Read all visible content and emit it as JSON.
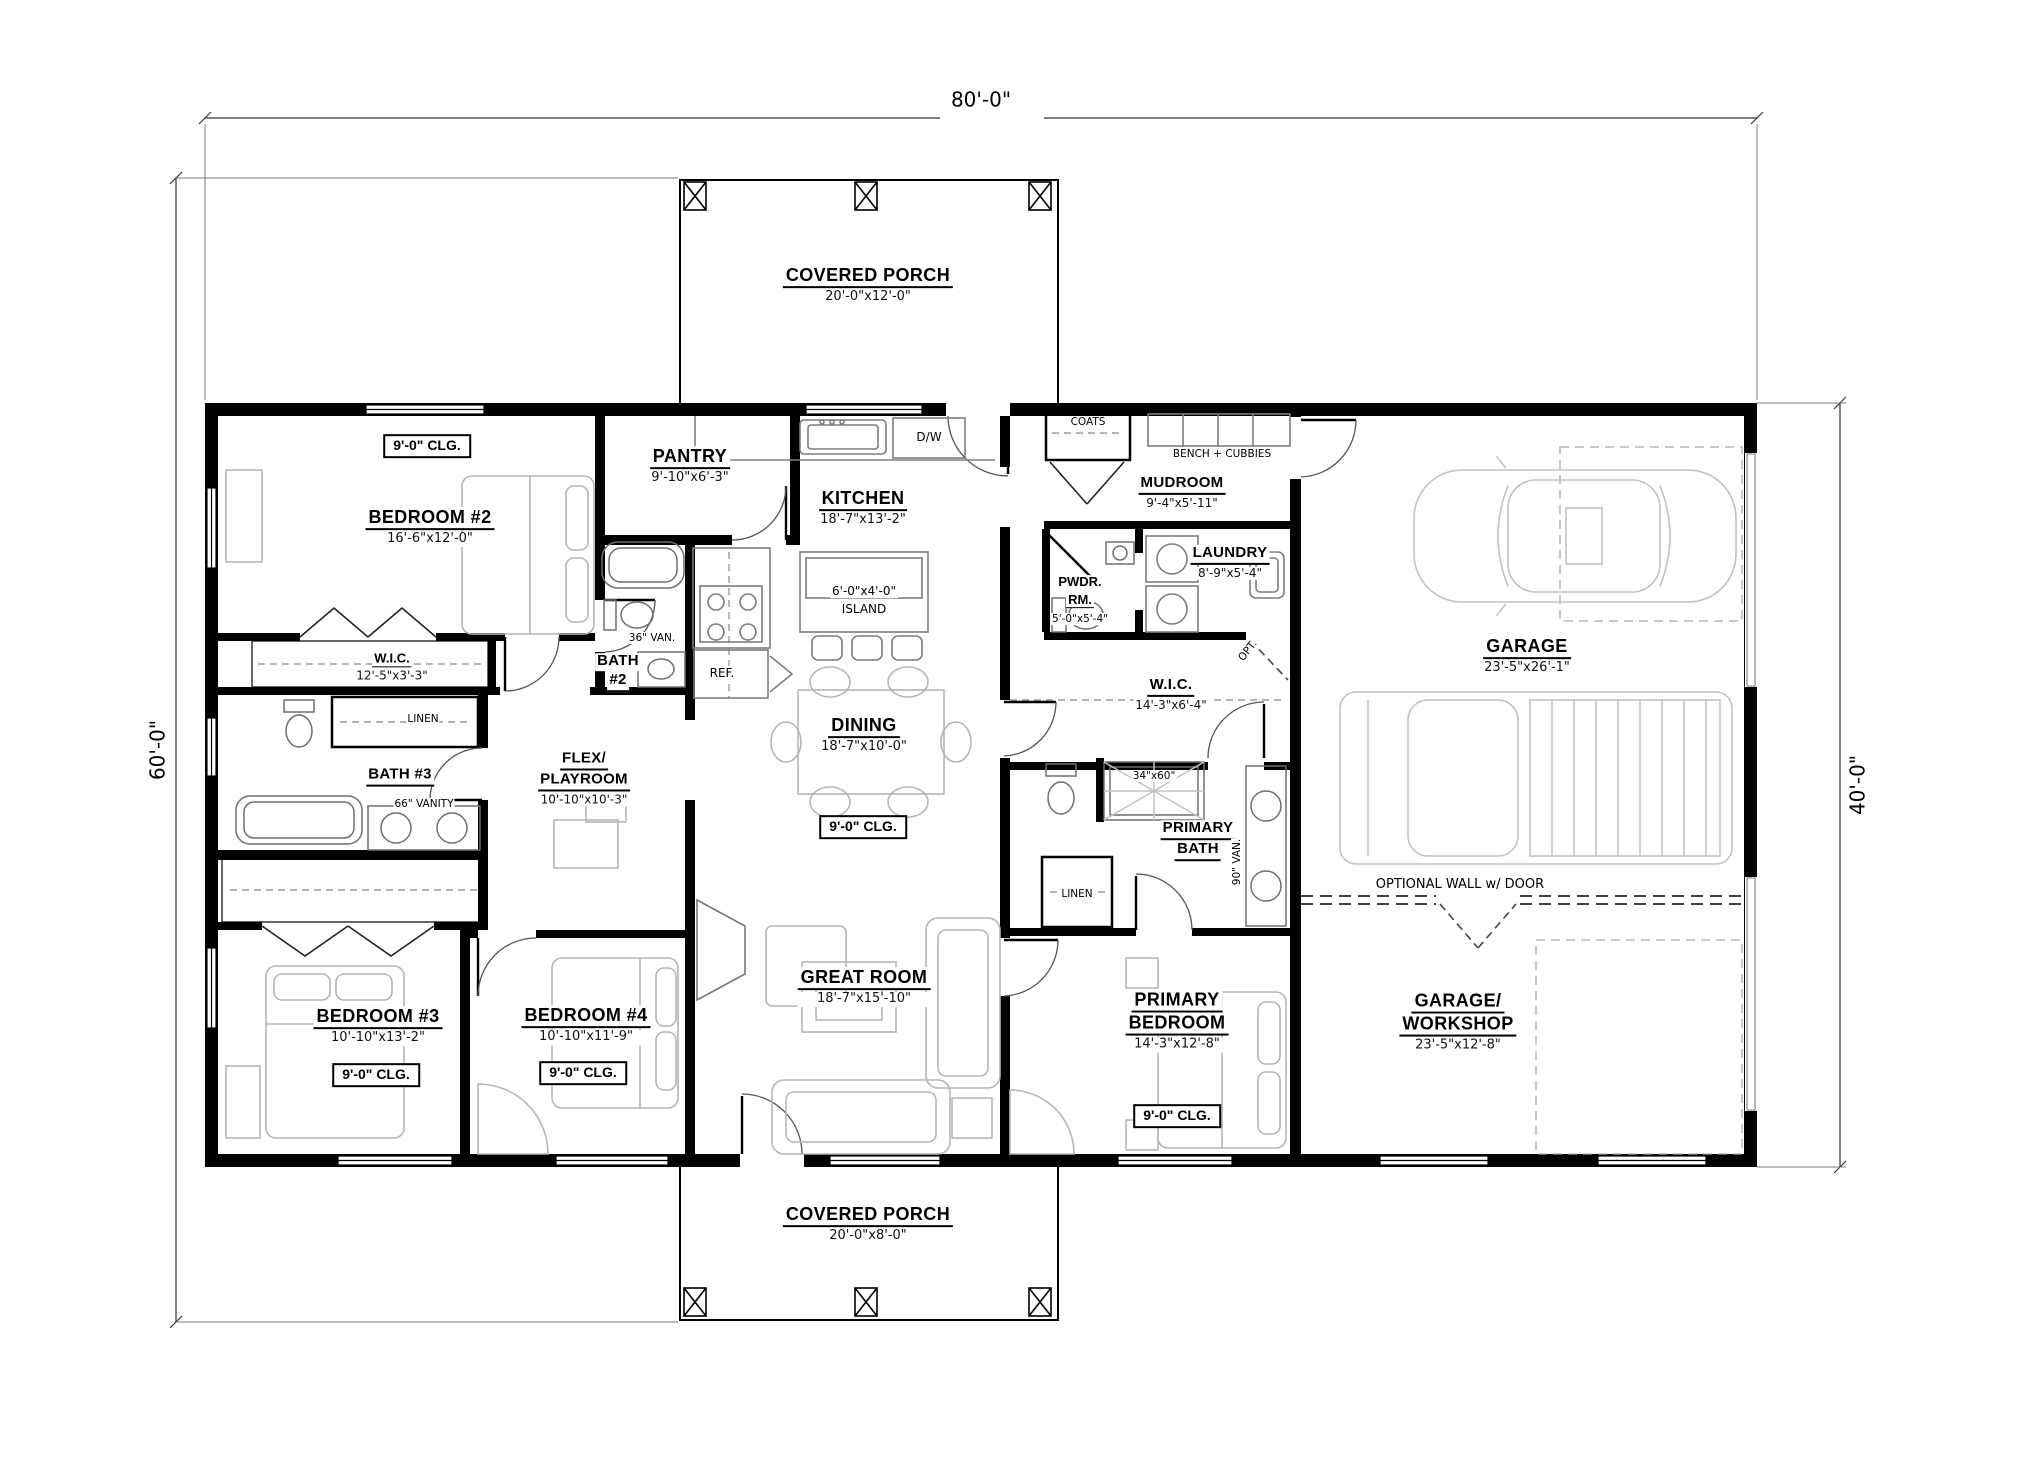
{
  "dimensions": {
    "width_top": "80'-0\"",
    "height_left": "60'-0\"",
    "height_right": "40'-0\""
  },
  "porches": {
    "top": {
      "name": "COVERED PORCH",
      "size": "20'-0\"x12'-0\""
    },
    "bottom": {
      "name": "COVERED PORCH",
      "size": "20'-0\"x8'-0\""
    }
  },
  "labels": {
    "ceiling": "9'-0\" CLG.",
    "optional_wall": "OPTIONAL WALL w/ DOOR",
    "opt": "OPT.",
    "coats": "COATS",
    "bench_cubbies": "BENCH + CUBBIES",
    "linen": "LINEN",
    "dw": "D/W",
    "ref": "REF.",
    "island_size": "6'-0\"x4'-0\"",
    "island": "ISLAND",
    "van_36": "36\" VAN.",
    "van_66": "66\" VANITY",
    "van_90": "90\" VAN.",
    "shower_size": "34\"x60\""
  },
  "rooms": {
    "bedroom2": {
      "name": "BEDROOM #2",
      "size": "16'-6\"x12'-0\""
    },
    "wic_bedroom2": {
      "name": "W.I.C.",
      "size": "12'-5\"x3'-3\""
    },
    "pantry": {
      "name": "PANTRY",
      "size": "9'-10\"x6'-3\""
    },
    "kitchen": {
      "name": "KITCHEN",
      "size": "18'-7\"x13'-2\""
    },
    "dining": {
      "name": "DINING",
      "size": "18'-7\"x10'-0\""
    },
    "great_room": {
      "name": "GREAT ROOM",
      "size": "18'-7\"x15'-10\""
    },
    "bath2": {
      "line1": "BATH",
      "line2": "#2"
    },
    "bath3": {
      "name": "BATH #3"
    },
    "flex": {
      "line1": "FLEX/",
      "line2": "PLAYROOM",
      "size": "10'-10\"x10'-3\""
    },
    "bedroom3": {
      "name": "BEDROOM #3",
      "size": "10'-10\"x13'-2\""
    },
    "bedroom4": {
      "name": "BEDROOM #4",
      "size": "10'-10\"x11'-9\""
    },
    "mudroom": {
      "name": "MUDROOM",
      "size": "9'-4\"x5'-11\""
    },
    "laundry": {
      "name": "LAUNDRY",
      "size": "8'-9\"x5'-4\""
    },
    "powder": {
      "line1": "PWDR.",
      "line2": "RM.",
      "size": "5'-0\"x5'-4\""
    },
    "wic_primary": {
      "name": "W.I.C.",
      "size": "14'-3\"x6'-4\""
    },
    "primary_bath": {
      "line1": "PRIMARY",
      "line2": "BATH"
    },
    "primary_bedroom": {
      "line1": "PRIMARY",
      "line2": "BEDROOM",
      "size": "14'-3\"x12'-8\""
    },
    "garage": {
      "name": "GARAGE",
      "size": "23'-5\"x26'-1\""
    },
    "garage_workshop": {
      "line1": "GARAGE/",
      "line2": "WORKSHOP",
      "size": "23'-5\"x12'-8\""
    }
  }
}
